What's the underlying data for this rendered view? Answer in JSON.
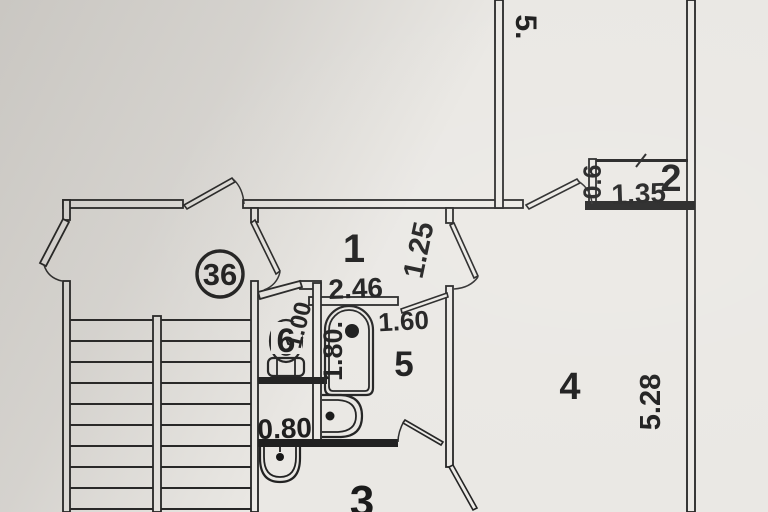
{
  "plan": {
    "apartment_number": "36",
    "room_labels": {
      "r1": "1",
      "r2": "2",
      "r3": "3",
      "r4": "4",
      "r5": "5",
      "r6": "6"
    },
    "dimensions": {
      "top_room_height": "5.",
      "closet_depth": "0.6",
      "closet_width": "1.35",
      "hall_width": "2.46",
      "corridor_width": "1.25",
      "bath_door": "1.60",
      "bathtub_length": "1.80.",
      "wc_width": "1.00",
      "storage_width": "0.80",
      "room4_height": "5.28"
    }
  }
}
